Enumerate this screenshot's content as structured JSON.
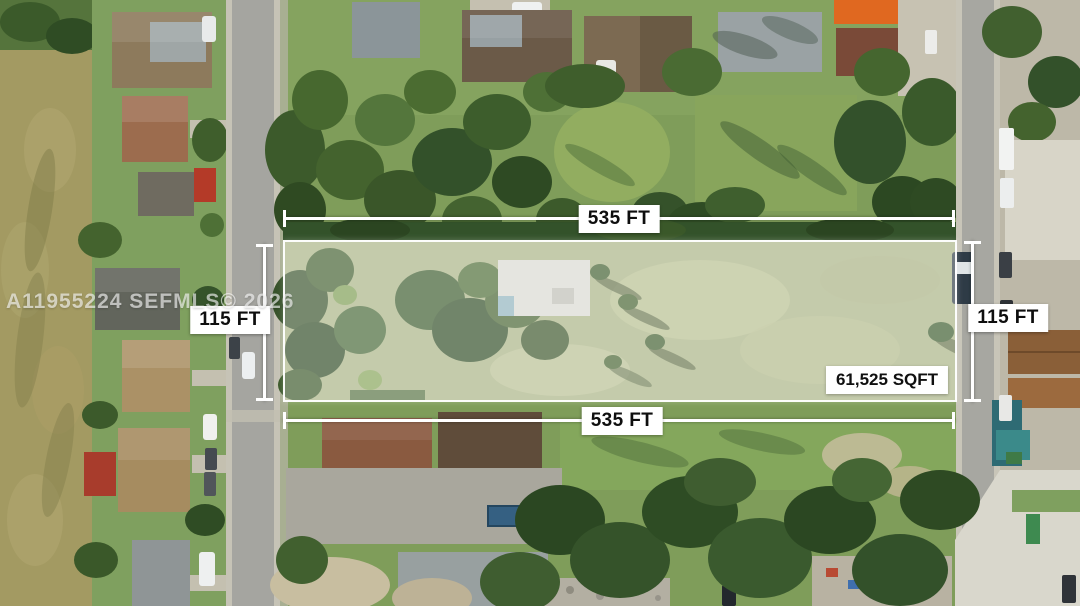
{
  "annotations": {
    "watermark": "A11955224 SEFMLS© 2026",
    "top_length": "535 FT",
    "bottom_length": "535 FT",
    "left_width": "115 FT",
    "right_width": "115 FT",
    "lot_area": "61,525 SQFT"
  },
  "colors": {
    "measure_line": "#ffffff",
    "label_background": "#ffffff",
    "label_text": "#0e0e0e",
    "parcel_fill": "rgba(255,255,255,0.32)",
    "parcel_border": "#ffffff",
    "watermark_text": "rgba(255,255,255,0.62)"
  }
}
